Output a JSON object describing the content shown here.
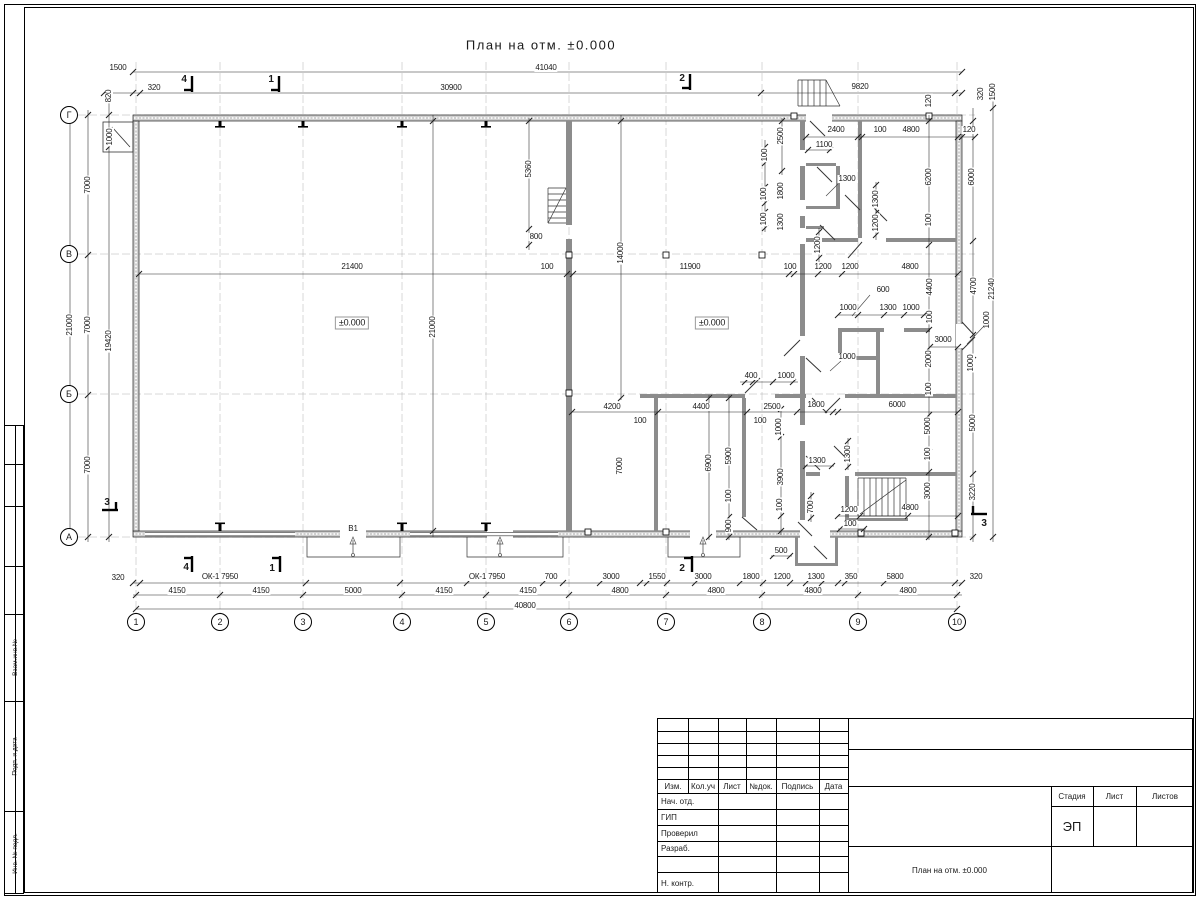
{
  "plan": {
    "title": "План на отм. ±0.000",
    "axes_bottom": [
      {
        "label": "1",
        "x": 136
      },
      {
        "label": "2",
        "x": 220
      },
      {
        "label": "3",
        "x": 303
      },
      {
        "label": "4",
        "x": 402
      },
      {
        "label": "5",
        "x": 486
      },
      {
        "label": "6",
        "x": 569
      },
      {
        "label": "7",
        "x": 666
      },
      {
        "label": "8",
        "x": 762
      },
      {
        "label": "9",
        "x": 858
      },
      {
        "label": "10",
        "x": 957
      }
    ],
    "axes_left": [
      {
        "label": "Г",
        "y": 115
      },
      {
        "label": "В",
        "y": 254
      },
      {
        "label": "Б",
        "y": 394
      },
      {
        "label": "А",
        "y": 537
      }
    ],
    "labels": [
      [
        "1500",
        118,
        68,
        ""
      ],
      [
        "41040",
        546,
        68,
        ""
      ],
      [
        "320",
        154,
        88,
        ""
      ],
      [
        "30900",
        451,
        88,
        ""
      ],
      [
        "9820",
        860,
        87,
        ""
      ],
      [
        "820",
        109,
        96,
        "r"
      ],
      [
        "120",
        929,
        101,
        "r"
      ],
      [
        "320",
        981,
        94,
        "r"
      ],
      [
        "1500",
        993,
        92,
        "r"
      ],
      [
        "120",
        969,
        130,
        ""
      ],
      [
        "4",
        184,
        80,
        "s"
      ],
      [
        "1",
        271,
        80,
        "s"
      ],
      [
        "2",
        682,
        79,
        "s"
      ],
      [
        "7000",
        88,
        185,
        "r"
      ],
      [
        "7000",
        88,
        325,
        "r"
      ],
      [
        "7000",
        88,
        465,
        "r"
      ],
      [
        "21000",
        70,
        325,
        "r"
      ],
      [
        "19420",
        109,
        341,
        "r"
      ],
      [
        "1000",
        110,
        137,
        "r"
      ],
      [
        "3",
        107,
        503,
        "s"
      ],
      [
        "3",
        984,
        524,
        "s"
      ],
      [
        "21400",
        352,
        267,
        ""
      ],
      [
        "100",
        547,
        267,
        ""
      ],
      [
        "11900",
        690,
        267,
        ""
      ],
      [
        "100",
        790,
        267,
        ""
      ],
      [
        "1200",
        823,
        267,
        ""
      ],
      [
        "1200",
        850,
        267,
        ""
      ],
      [
        "4800",
        910,
        267,
        ""
      ],
      [
        "21000",
        433,
        327,
        "r"
      ],
      [
        "5360",
        529,
        169,
        "r"
      ],
      [
        "800",
        536,
        237,
        ""
      ],
      [
        "14000",
        621,
        253,
        "r"
      ],
      [
        "1200",
        818,
        245,
        "r"
      ],
      [
        "±0.000",
        352,
        323,
        "b"
      ],
      [
        "±0.000",
        712,
        323,
        "b"
      ],
      [
        "2400",
        836,
        130,
        ""
      ],
      [
        "100",
        880,
        130,
        ""
      ],
      [
        "4800",
        911,
        130,
        ""
      ],
      [
        "2500",
        781,
        136,
        "r"
      ],
      [
        "1100",
        824,
        145,
        ""
      ],
      [
        "100",
        765,
        155,
        "r"
      ],
      [
        "1800",
        781,
        191,
        "r"
      ],
      [
        "100",
        764,
        194,
        "r"
      ],
      [
        "1300",
        781,
        222,
        "r"
      ],
      [
        "100",
        764,
        219,
        "r"
      ],
      [
        "1300",
        847,
        179,
        ""
      ],
      [
        "1300",
        876,
        199,
        "r"
      ],
      [
        "1200",
        876,
        223,
        "r"
      ],
      [
        "6200",
        929,
        177,
        "r"
      ],
      [
        "100",
        929,
        220,
        "r"
      ],
      [
        "6000",
        972,
        177,
        "r"
      ],
      [
        "600",
        883,
        290,
        ""
      ],
      [
        "1000",
        848,
        308,
        ""
      ],
      [
        "1300",
        888,
        308,
        ""
      ],
      [
        "1000",
        911,
        308,
        ""
      ],
      [
        "4400",
        930,
        287,
        "r"
      ],
      [
        "100",
        930,
        317,
        "r"
      ],
      [
        "4700",
        974,
        286,
        "r"
      ],
      [
        "21240",
        992,
        289,
        "r"
      ],
      [
        "1000",
        987,
        320,
        "r"
      ],
      [
        "3000",
        943,
        340,
        ""
      ],
      [
        "2000",
        929,
        359,
        "r"
      ],
      [
        "1000",
        847,
        357,
        ""
      ],
      [
        "1000",
        971,
        363,
        "r"
      ],
      [
        "100",
        929,
        389,
        "r"
      ],
      [
        "400",
        751,
        376,
        ""
      ],
      [
        "1000",
        786,
        376,
        ""
      ],
      [
        "4200",
        612,
        407,
        ""
      ],
      [
        "4400",
        701,
        407,
        ""
      ],
      [
        "2500",
        772,
        407,
        ""
      ],
      [
        "1800",
        816,
        405,
        ""
      ],
      [
        "6000",
        897,
        405,
        ""
      ],
      [
        "100",
        640,
        421,
        ""
      ],
      [
        "100",
        760,
        421,
        ""
      ],
      [
        "1000",
        779,
        427,
        "r"
      ],
      [
        "7000",
        620,
        466,
        "r"
      ],
      [
        "6900",
        709,
        463,
        "r"
      ],
      [
        "5900",
        729,
        456,
        "r"
      ],
      [
        "100",
        729,
        496,
        "r"
      ],
      [
        "900",
        729,
        526,
        "r"
      ],
      [
        "3900",
        781,
        477,
        "r"
      ],
      [
        "100",
        780,
        505,
        "r"
      ],
      [
        "700",
        811,
        507,
        "r"
      ],
      [
        "1300",
        817,
        461,
        ""
      ],
      [
        "1300",
        848,
        454,
        "r"
      ],
      [
        "5000",
        928,
        426,
        "r"
      ],
      [
        "100",
        928,
        454,
        "r"
      ],
      [
        "3000",
        928,
        491,
        "r"
      ],
      [
        "5000",
        973,
        423,
        "r"
      ],
      [
        "3220",
        973,
        492,
        "r"
      ],
      [
        "1200",
        849,
        510,
        ""
      ],
      [
        "100",
        850,
        524,
        ""
      ],
      [
        "4800",
        910,
        508,
        ""
      ],
      [
        "320",
        118,
        578,
        ""
      ],
      [
        "ОК-1 7950",
        220,
        577,
        ""
      ],
      [
        "ОК-1 7950",
        487,
        577,
        ""
      ],
      [
        "700",
        551,
        577,
        ""
      ],
      [
        "3000",
        611,
        577,
        ""
      ],
      [
        "1550",
        657,
        577,
        ""
      ],
      [
        "3000",
        703,
        577,
        ""
      ],
      [
        "1800",
        751,
        577,
        ""
      ],
      [
        "1200",
        782,
        577,
        ""
      ],
      [
        "500",
        781,
        551,
        ""
      ],
      [
        "1300",
        816,
        577,
        ""
      ],
      [
        "350",
        851,
        577,
        ""
      ],
      [
        "5800",
        895,
        577,
        ""
      ],
      [
        "320",
        976,
        577,
        ""
      ],
      [
        "4150",
        177,
        591,
        ""
      ],
      [
        "4150",
        261,
        591,
        ""
      ],
      [
        "5000",
        353,
        591,
        ""
      ],
      [
        "4150",
        444,
        591,
        ""
      ],
      [
        "4150",
        528,
        591,
        ""
      ],
      [
        "4800",
        620,
        591,
        ""
      ],
      [
        "4800",
        716,
        591,
        ""
      ],
      [
        "4800",
        813,
        591,
        ""
      ],
      [
        "4800",
        908,
        591,
        ""
      ],
      [
        "40800",
        525,
        606,
        ""
      ],
      [
        "В1",
        353,
        529,
        ""
      ],
      [
        "4",
        186,
        568,
        "s"
      ],
      [
        "1",
        272,
        569,
        "s"
      ],
      [
        "2",
        682,
        569,
        "s"
      ]
    ]
  },
  "frame": {
    "side_labels": [
      "Взам.инв.№",
      "Подп. и дата",
      "Инв. № подл."
    ]
  },
  "title_block": {
    "header_cols": [
      "Изм.",
      "Кол.уч",
      "Лист",
      "№док.",
      "Подпись",
      "Дата"
    ],
    "rows": [
      "Нач. отд.",
      "ГИП",
      "Проверил",
      "Разраб.",
      "",
      "Н. контр."
    ],
    "stage_cols": [
      "Стадия",
      "Лист",
      "Листов"
    ],
    "stage_value": "ЭП",
    "doc_title": "План на отм. ±0.000"
  }
}
